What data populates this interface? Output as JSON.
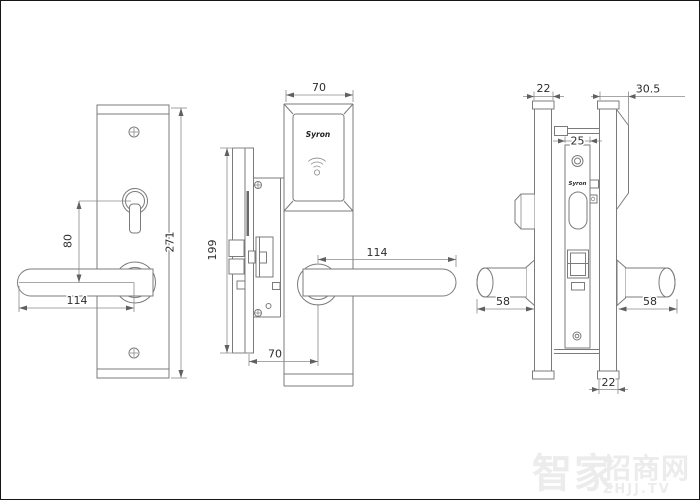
{
  "document": {
    "type": "technical-drawing",
    "subject": "card-access mortise door lock, three orthographic views",
    "units": "mm"
  },
  "labels": {
    "reader_brand": "Syron",
    "faceplate_brand": "Syron"
  },
  "dimensions": {
    "interior_overall_height": "271",
    "interior_thumbturn_to_handle": "80",
    "interior_handle_length": "114",
    "exterior_plate_width": "70",
    "exterior_handle_length": "114",
    "backset": "70",
    "faceplate_height": "199",
    "interior_plate_depth_top": "22",
    "exterior_plate_depth": "30.5",
    "faceplate_width": "25",
    "interior_handle_projection": "58",
    "exterior_handle_projection": "58",
    "interior_plate_depth_bottom": "22"
  },
  "watermark": {
    "cjk_large": "智家",
    "cjk_small": "招商网",
    "latin": "ZHJJ.TV"
  },
  "colors": {
    "background": "#ffffff",
    "border": "#161616",
    "line": "#7b7b7b",
    "dim_text": "#2d2d2d",
    "slot_fill": "#6a6a6a",
    "watermark": "#ececec"
  }
}
